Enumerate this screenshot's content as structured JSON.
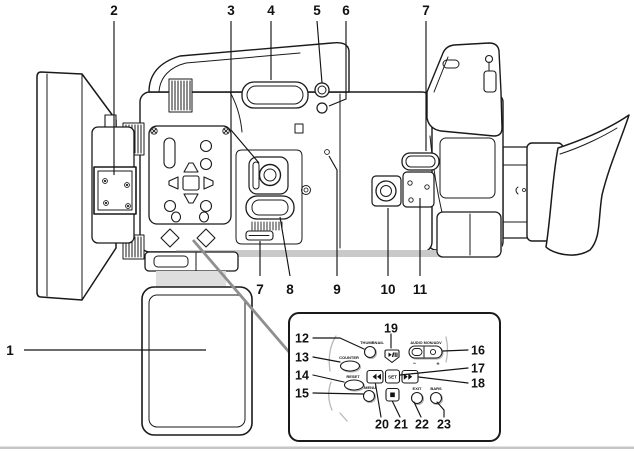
{
  "page": {
    "background": "#ffffff"
  },
  "colors": {
    "ink": "#1a1a1a",
    "shade": "#c9c9c9",
    "inset_leader": "#8f8f8f"
  },
  "figure": {
    "description": "Left-side line-art view of a professional camcorder with numbered part callouts and a magnified inset of the playback control panel",
    "callouts": {
      "c1": "1",
      "c2": "2",
      "c3": "3",
      "c4": "4",
      "c5": "5",
      "c6": "6",
      "c7": "7",
      "c8": "8",
      "c9": "9",
      "c10": "10",
      "c11": "11",
      "c12": "12",
      "c13": "13",
      "c14": "14",
      "c15": "15",
      "c16": "16",
      "c17": "17",
      "c18": "18",
      "c19": "19",
      "c20": "20",
      "c21": "21",
      "c22": "22",
      "c23": "23"
    },
    "inset": {
      "labels": {
        "thumbnail": "THUMBNAIL",
        "counter": "COUNTER",
        "reset": "RESET",
        "menu": "MENU",
        "audio_mon_adv": "AUDIO MON/ADV",
        "minus": "−",
        "plus": "+",
        "set": "SET",
        "exit": "EXIT",
        "bars": "BARS"
      },
      "icons": {
        "play_pause": "play-pause-icon",
        "rewind": "rewind-icon",
        "fast_forward": "fast-forward-icon",
        "stop": "stop-icon"
      }
    }
  }
}
